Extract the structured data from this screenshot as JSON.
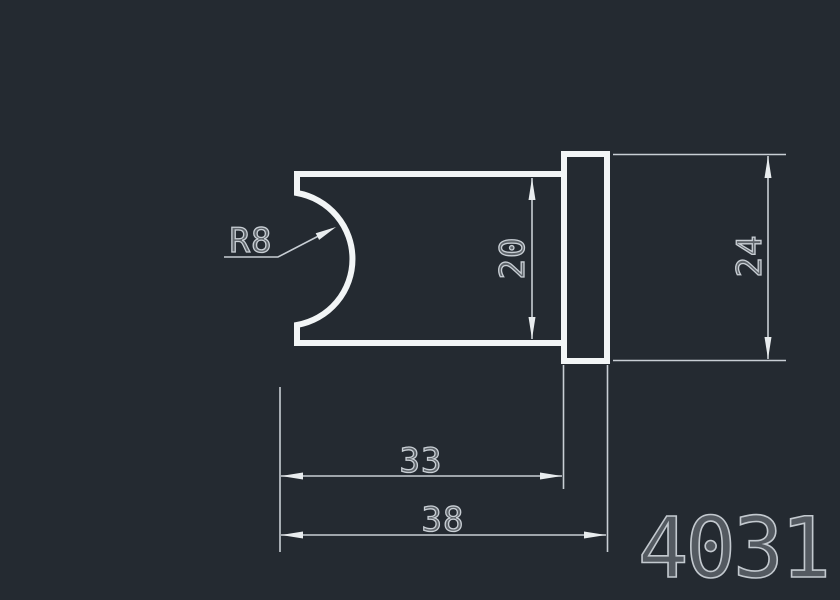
{
  "drawing": {
    "part_number": "4031",
    "dimension_labels": {
      "radius": "R8",
      "body_height": "20",
      "flange_height": "24",
      "body_length": "33",
      "overall_length": "38"
    },
    "dimension_values": {
      "radius": 8,
      "body_height": 20,
      "flange_height": 24,
      "body_length": 33,
      "overall_length": 38
    },
    "colors": {
      "background": "#242a31",
      "part_outline": "#f2f5f6",
      "dimension_lines": "#c8ced4",
      "arrowheads": "#e8ecee",
      "dimension_text": "#c9cfd5",
      "part_number_text": "#c3c9cf"
    }
  }
}
